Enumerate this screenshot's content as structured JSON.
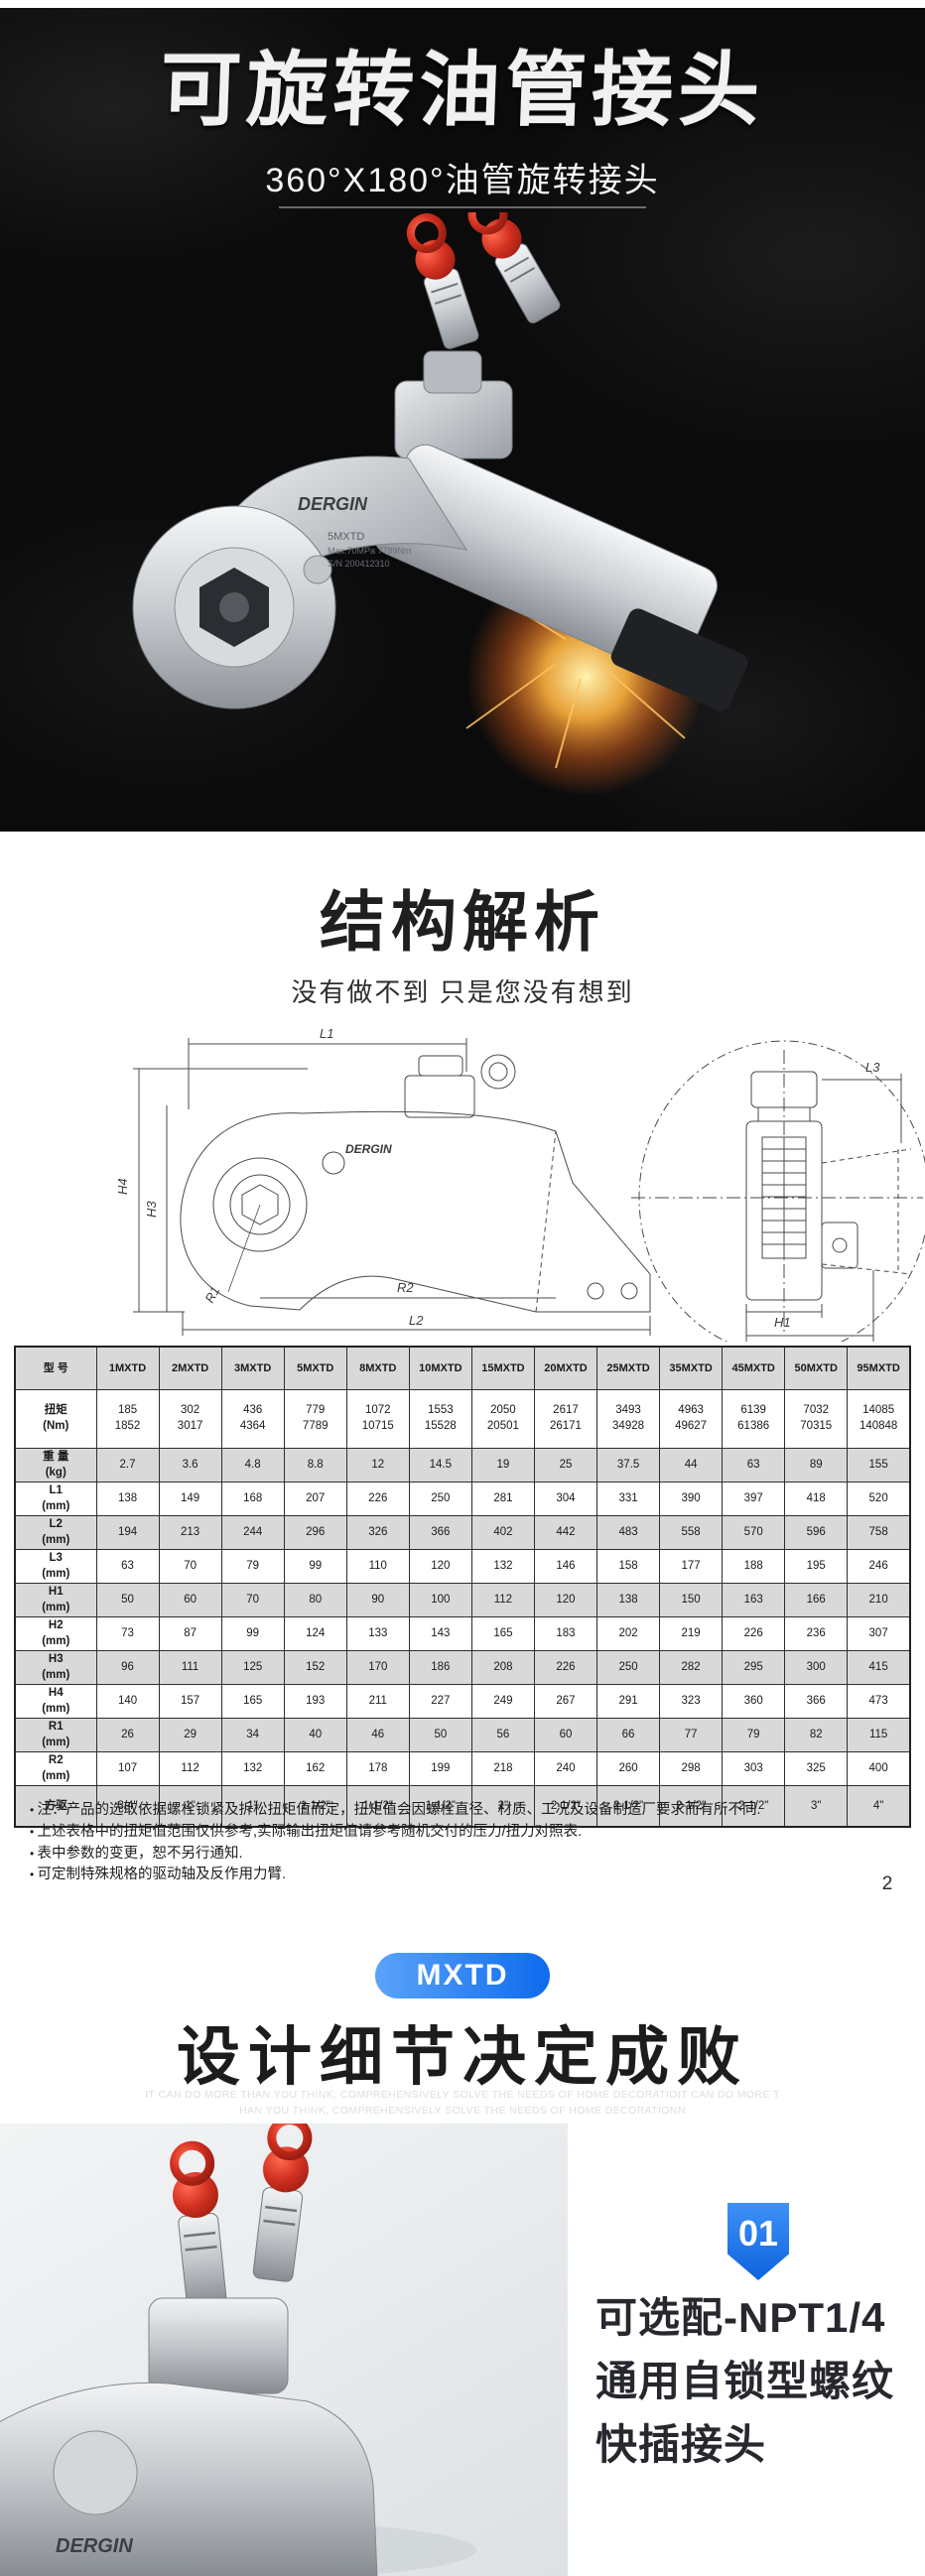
{
  "hero": {
    "title": "可旋转油管接头",
    "subtitle": "360°X180°油管旋转接头",
    "brand": "DERGIN",
    "model": "5MXTD",
    "spec": "Max.70MPa 7789Nm",
    "serial": "S/N 200412310"
  },
  "structure": {
    "title": "结构解析",
    "subtitle": "没有做不到  只是您没有想到",
    "diagram_brand": "DERGIN",
    "left_labels": [
      "L1",
      "H4",
      "H3",
      "R1",
      "R2",
      "L2"
    ],
    "right_labels": [
      "L3",
      "H1",
      "H2"
    ]
  },
  "spec_table": {
    "header": [
      "型 号",
      "1MXTD",
      "2MXTD",
      "3MXTD",
      "5MXTD",
      "8MXTD",
      "10MXTD",
      "15MXTD",
      "20MXTD",
      "25MXTD",
      "35MXTD",
      "45MXTD",
      "50MXTD",
      "95MXTD"
    ],
    "rows": [
      {
        "label": "扭矩",
        "unit": "(Nm)",
        "values": [
          "185\n1852",
          "302\n3017",
          "436\n4364",
          "779\n7789",
          "1072\n10715",
          "1553\n15528",
          "2050\n20501",
          "2617\n26171",
          "3493\n34928",
          "4963\n49627",
          "6139\n61386",
          "7032\n70315",
          "14085\n140848"
        ]
      },
      {
        "label": "重 量",
        "unit": "(kg)",
        "values": [
          "2.7",
          "3.6",
          "4.8",
          "8.8",
          "12",
          "14.5",
          "19",
          "25",
          "37.5",
          "44",
          "63",
          "89",
          "155"
        ]
      },
      {
        "label": "L1",
        "unit": "(mm)",
        "values": [
          "138",
          "149",
          "168",
          "207",
          "226",
          "250",
          "281",
          "304",
          "331",
          "390",
          "397",
          "418",
          "520"
        ]
      },
      {
        "label": "L2",
        "unit": "(mm)",
        "values": [
          "194",
          "213",
          "244",
          "296",
          "326",
          "366",
          "402",
          "442",
          "483",
          "558",
          "570",
          "596",
          "758"
        ]
      },
      {
        "label": "L3",
        "unit": "(mm)",
        "values": [
          "63",
          "70",
          "79",
          "99",
          "110",
          "120",
          "132",
          "146",
          "158",
          "177",
          "188",
          "195",
          "246"
        ]
      },
      {
        "label": "H1",
        "unit": "(mm)",
        "values": [
          "50",
          "60",
          "70",
          "80",
          "90",
          "100",
          "112",
          "120",
          "138",
          "150",
          "163",
          "166",
          "210"
        ]
      },
      {
        "label": "H2",
        "unit": "(mm)",
        "values": [
          "73",
          "87",
          "99",
          "124",
          "133",
          "143",
          "165",
          "183",
          "202",
          "219",
          "226",
          "236",
          "307"
        ]
      },
      {
        "label": "H3",
        "unit": "(mm)",
        "values": [
          "96",
          "111",
          "125",
          "152",
          "170",
          "186",
          "208",
          "226",
          "250",
          "282",
          "295",
          "300",
          "415"
        ]
      },
      {
        "label": "H4",
        "unit": "(mm)",
        "values": [
          "140",
          "157",
          "165",
          "193",
          "211",
          "227",
          "249",
          "267",
          "291",
          "323",
          "360",
          "366",
          "473"
        ]
      },
      {
        "label": "R1",
        "unit": "(mm)",
        "values": [
          "26",
          "29",
          "34",
          "40",
          "46",
          "50",
          "56",
          "60",
          "66",
          "77",
          "79",
          "82",
          "115"
        ]
      },
      {
        "label": "R2",
        "unit": "(mm)",
        "values": [
          "107",
          "112",
          "132",
          "162",
          "178",
          "199",
          "218",
          "240",
          "260",
          "298",
          "303",
          "325",
          "400"
        ]
      },
      {
        "label": "方驱",
        "unit": "",
        "values": [
          "3/4\"",
          "1\"",
          "1\"",
          "1-1/2\"",
          "1-1/2\"",
          "1-1/2\"",
          "2\"",
          "2-1/2\"",
          "2-1/2\"",
          "2-1/2\"",
          "2-1/2\"",
          "3\"",
          "4\""
        ]
      }
    ]
  },
  "notes": [
    "注：产品的选取依据螺栓锁紧及拆松扭矩值而定，扭矩值会因螺栓直径、材质、工况及设备制造厂要求而有所不同.",
    "上述表格中的扭矩值范围仅供参考,实际输出扭矩值请参考随机交付的压力/扭力对照表.",
    "表中参数的变更，恕不另行通知.",
    "可定制特殊规格的驱动轴及反作用力臂."
  ],
  "page_number": "2",
  "series_badge": "MXTD",
  "design": {
    "title": "设计细节决定成败",
    "watermark_line1": "IT CAN DO MORE THAN YOU THINK, COMPREHENSIVELY SOLVE THE NEEDS OF HOME DECORATIOIT CAN DO MORE T",
    "watermark_line2": "HAN YOU THINK, COMPREHENSIVELY SOLVE THE NEEDS OF HOME DECORATIONN"
  },
  "feature": {
    "number": "01",
    "text": "可选配-NPT1/4 通用自锁型螺纹快插接头",
    "brand": "DERGIN"
  },
  "colors": {
    "badge_blue_start": "#5aa3f8",
    "badge_blue_end": "#0e6bee",
    "coupler_red": "#d23020",
    "hero_bg": "#0b0b0c",
    "table_shade": "#d9d9d9"
  }
}
